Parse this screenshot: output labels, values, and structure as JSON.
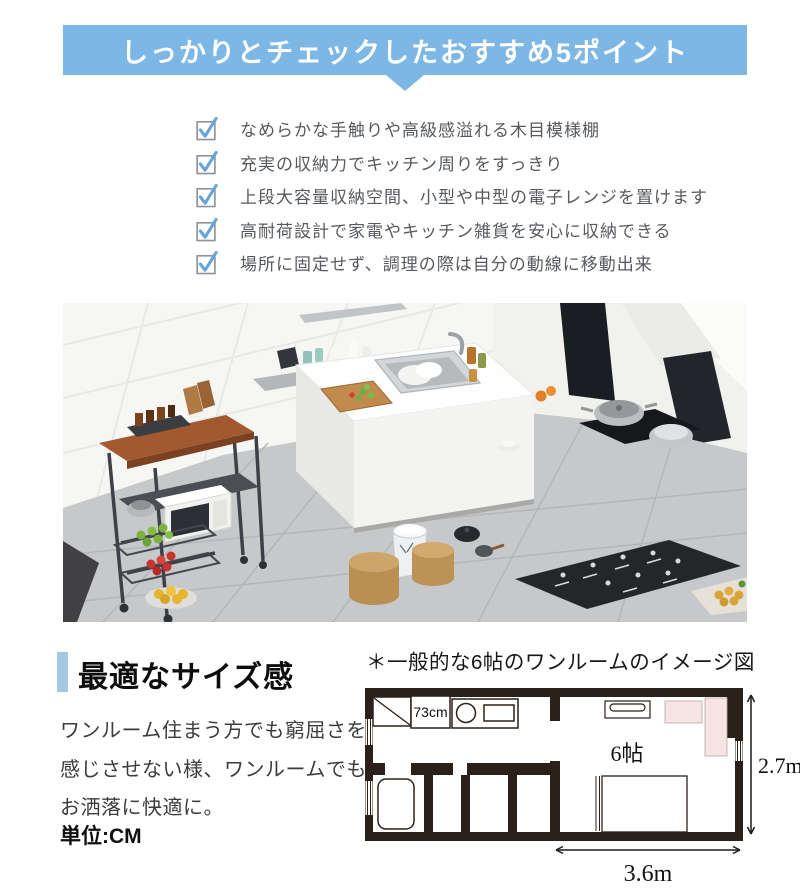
{
  "banner": {
    "title": "しっかりとチェックしたおすすめ5ポイント"
  },
  "checklist": [
    {
      "label": "なめらかな手触りや高級感溢れる木目模様棚"
    },
    {
      "label": "充実の収納力でキッチン周りをすっきり"
    },
    {
      "label": "上段大容量収納空間、小型や中型の電子レンジを置けます"
    },
    {
      "label": "高耐荷設計で家電やキッチン雑貨を安心に収納できる"
    },
    {
      "label": "場所に固定せず、調理の際は自分の動線に移動出来"
    }
  ],
  "size_section": {
    "heading": "最適なサイズ感",
    "body_line1": "ワンルーム住まう方でも窮屈さを",
    "body_line2": "感じさせない様、ワンルームでも",
    "body_line3": "お洒落に快適に。",
    "unit_label": "単位:CM"
  },
  "floorplan": {
    "title": "＊一般的な6帖のワンルームのイメージ図",
    "rack_width_label": "73cm",
    "room_label": "6帖",
    "height_label": "2.7m",
    "width_label": "3.6m"
  },
  "colors": {
    "banner_blue": "#7db7e5",
    "heading_bar_blue": "#a5c8e2",
    "check_blue": "#66a3d6",
    "plan_wall_black": "#2b201a",
    "plan_pink": "#f7e4e4",
    "list_text_gray": "#56595d"
  }
}
